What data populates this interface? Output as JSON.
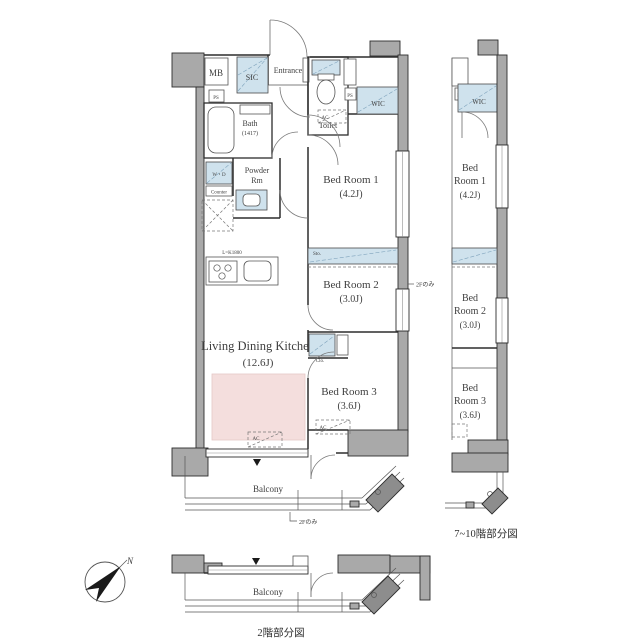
{
  "colors": {
    "wall_gray": "#a9a9a9",
    "hatch_blue": "#cfe2ed",
    "rug_pink": "#f4dedd",
    "line": "#2d2d2d"
  },
  "plan": {
    "mb": "MB",
    "ps": "PS",
    "sic": "SIC",
    "entrance": "Entrance",
    "toilet": "Toilet",
    "wic": "WIC",
    "bath_l1": "Bath",
    "bath_l2": "(1417)",
    "powder_l1": "Powder",
    "powder_l2": "Rm",
    "wd": "W・D",
    "counter": "Counter",
    "kitchen_len": "L=K1800",
    "ldk_l1": "Living Dining Kitchen",
    "ldk_l2": "(12.6J)",
    "bed1_l1": "Bed Room 1",
    "bed1_l2": "(4.2J)",
    "bed2_l1": "Bed Room 2",
    "bed2_l2": "(3.0J)",
    "bed3_l1": "Bed Room 3",
    "bed3_l2": "(3.6J)",
    "sto": "Sto.",
    "clo": "Clo.",
    "ac": "AC",
    "balcony": "Balcony",
    "only2f": "2Fのみ"
  },
  "sub_upper": {
    "caption": "7~10階部分図",
    "wic": "WIC",
    "ps": "PS",
    "bed1_l1": "Bed",
    "bed1_l2": "Room 1",
    "bed1_l3": "(4.2J)",
    "bed2_l1": "Bed",
    "bed2_l2": "Room 2",
    "bed2_l3": "(3.0J)",
    "bed3_l1": "Bed",
    "bed3_l2": "Room 3",
    "bed3_l3": "(3.6J)"
  },
  "sub_lower": {
    "caption": "2階部分図",
    "balcony": "Balcony"
  },
  "compass": {
    "north": "N"
  }
}
